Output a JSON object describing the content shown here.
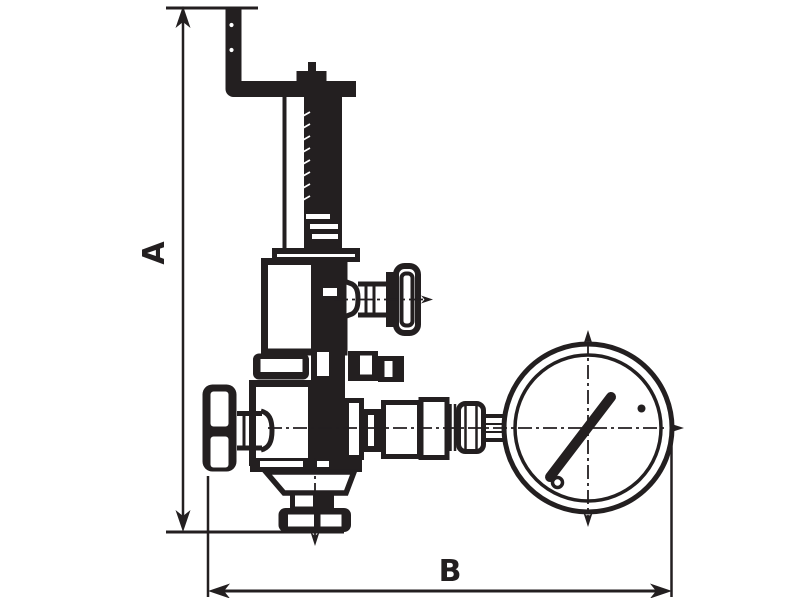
{
  "dimension_labels": {
    "vertical": "A",
    "horizontal": "B"
  },
  "colors": {
    "ink": "#231f20",
    "background": "#ffffff"
  }
}
